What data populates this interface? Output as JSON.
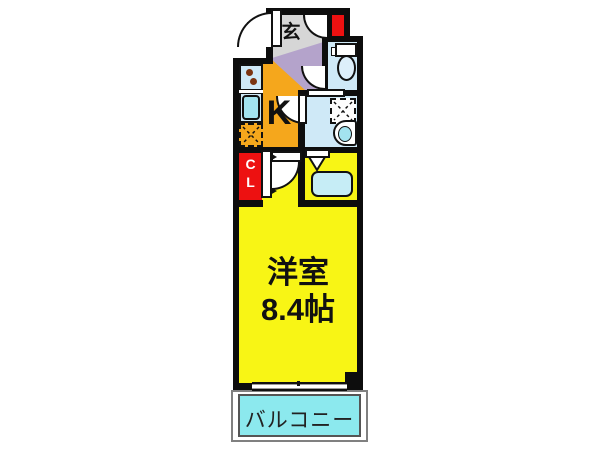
{
  "plan": {
    "genkan": {
      "label": "玄"
    },
    "kitchen": {
      "label": "K"
    },
    "closet": {
      "line1": "C",
      "line2": "L"
    },
    "room": {
      "name": "洋室",
      "size": "8.4帖"
    },
    "balcony": {
      "label": "バルコニー"
    }
  },
  "colors": {
    "wall": "#0d0d0d",
    "room_yellow": "#f8f515",
    "kitchen_orange": "#f5a71c",
    "hall_purple": "#b4a3cb",
    "genkan_gray": "#d6d6d6",
    "closet_red": "#ed1111",
    "wet_area_blue": "#cfe9f7",
    "fixture_cyan": "#a3e3ef",
    "bathtub_cyan": "#c6edf6",
    "balcony_cyan": "#8ce9ee"
  },
  "fixtures": [
    "entrance-door",
    "toilet",
    "washing-machine-space",
    "wash-basin",
    "bathtub",
    "kitchen-sink",
    "stove",
    "refrigerator-space",
    "sliding-window",
    "closet-door"
  ]
}
